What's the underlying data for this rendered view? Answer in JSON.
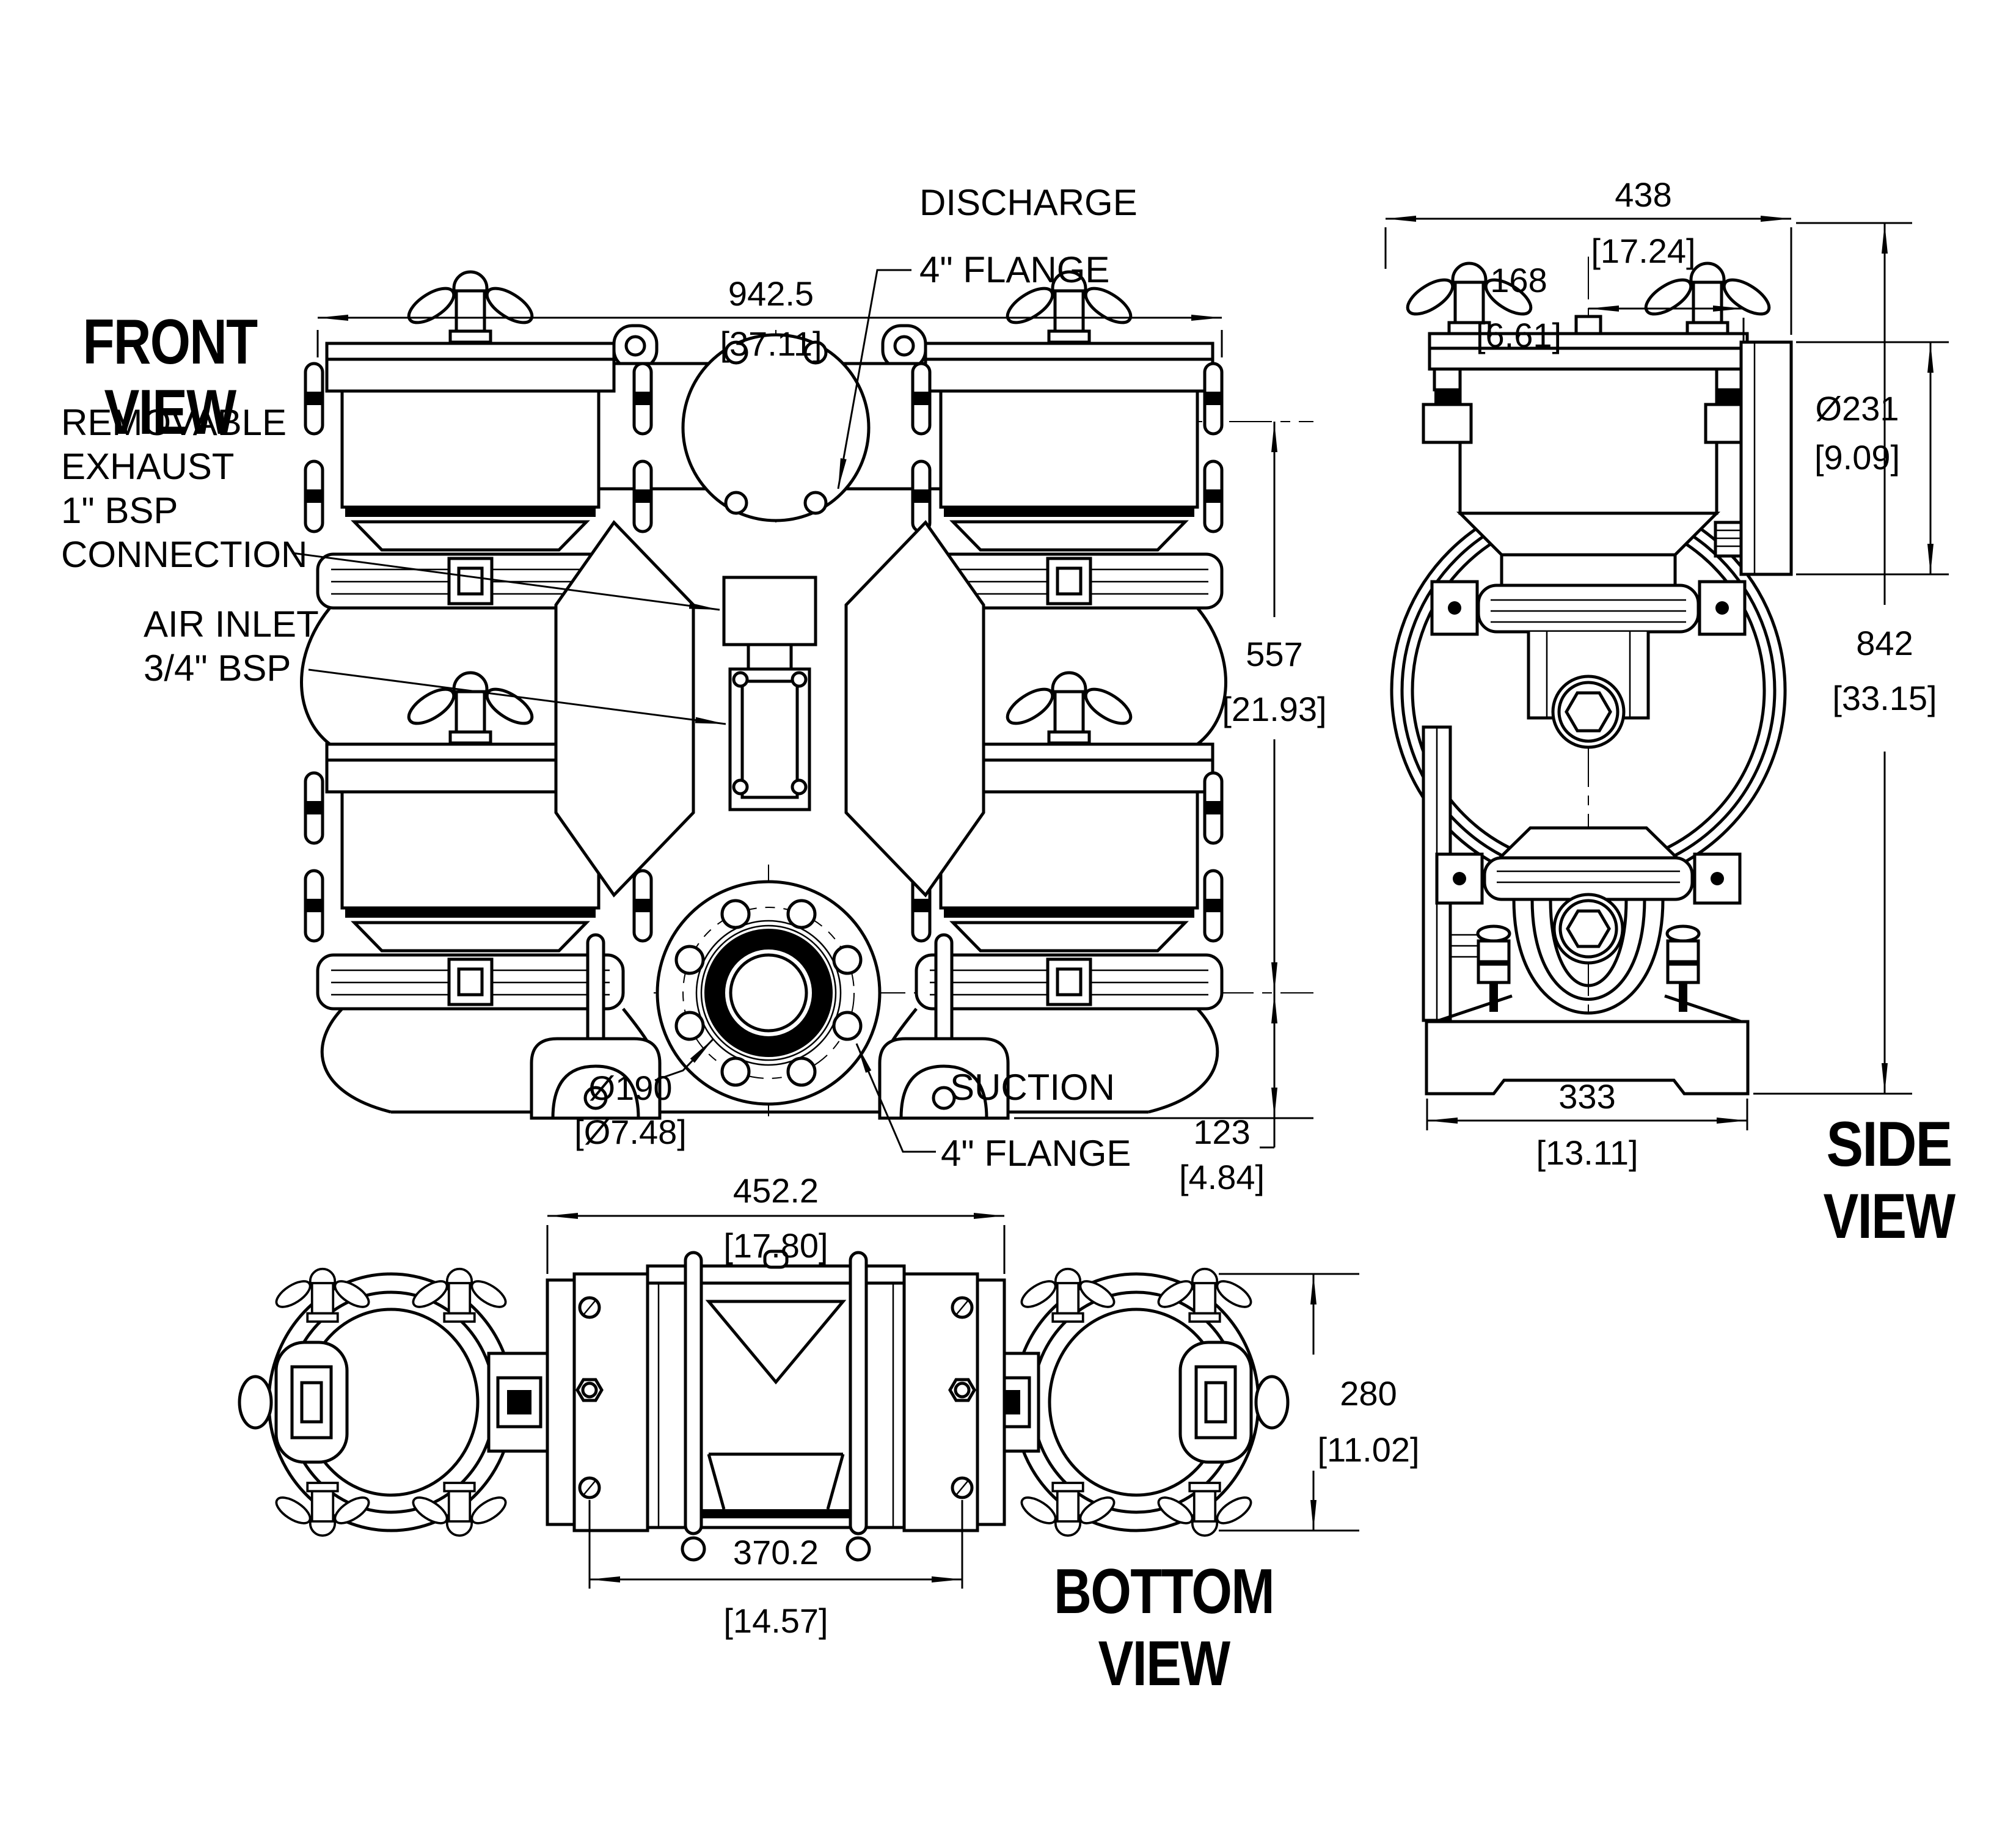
{
  "views": {
    "front": {
      "l1": "FRONT",
      "l2": "VIEW"
    },
    "side": {
      "l1": "SIDE",
      "l2": "VIEW"
    },
    "bottom": {
      "l1": "BOTTOM",
      "l2": "VIEW"
    }
  },
  "callouts": {
    "discharge": {
      "l1": "DISCHARGE",
      "l2": "4\" FLANGE"
    },
    "exhaust": {
      "l1": "REMOVABLE",
      "l2": "EXHAUST",
      "l3": "1\" BSP",
      "l4": "CONNECTION"
    },
    "air": {
      "l1": "AIR INLET",
      "l2": "3/4\" BSP"
    },
    "suction": {
      "l1": "SUCTION",
      "l2": "4\" FLANGE"
    }
  },
  "dims": {
    "overall_width": {
      "mm": "942.5",
      "in": "[37.11]"
    },
    "discharge_height": {
      "mm": "557",
      "in": "[21.93]"
    },
    "suction_drop": {
      "mm": "123",
      "in": "[4.84]"
    },
    "suction_bore": {
      "mm": "Ø190",
      "in": "[Ø7.48]"
    },
    "depth": {
      "mm": "438",
      "in": "[17.24]"
    },
    "flange_face_offset": {
      "mm": "168",
      "in": "[6.61]"
    },
    "flange_od": {
      "mm": "Ø231",
      "in": "[9.09]"
    },
    "overall_height": {
      "mm": "842",
      "in": "[33.15]"
    },
    "base_depth": {
      "mm": "333",
      "in": "[13.11]"
    },
    "foot_plate_span": {
      "mm": "452.2",
      "in": "[17.80]"
    },
    "foot_hole_span": {
      "mm": "370.2",
      "in": "[14.57]"
    },
    "clamp_width": {
      "mm": "280",
      "in": "[11.02]"
    }
  }
}
